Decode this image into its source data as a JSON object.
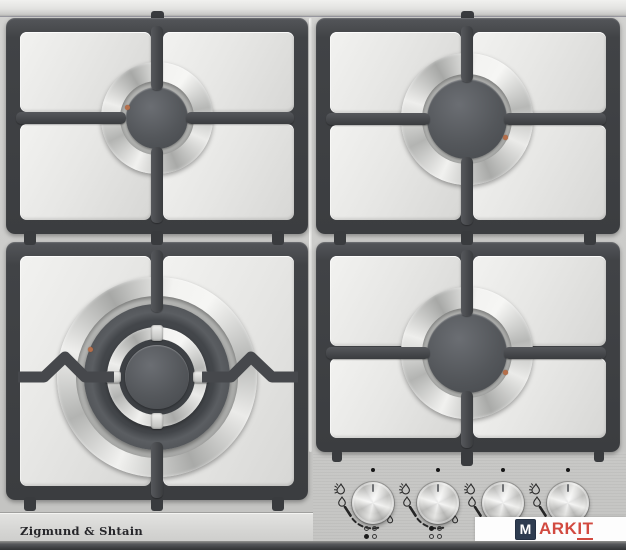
{
  "scene": {
    "type": "product-photo",
    "subject": "Built-in 4-burner gas hob, stainless steel, cast-iron pan supports, 4 control knobs"
  },
  "brand": {
    "label": "Zigmund & Shtain"
  },
  "watermark": {
    "m": "M",
    "ark": "ARK",
    "it": "IT",
    "navy": "#2e3c50",
    "red": "#d24a40",
    "box": "#fdfdfd"
  },
  "palette": {
    "steel_surface": "#cdcdcb",
    "steel_panel": "#e8e8e6",
    "grate": "#3f4144",
    "burner_cap": "#53565a",
    "chrome": "#dcdcda",
    "igniter_dot": "#b56f4b",
    "bottom_edge": "#47494b"
  },
  "burners": [
    {
      "id": "rear-left",
      "size": "medium"
    },
    {
      "id": "rear-right",
      "size": "large"
    },
    {
      "id": "front-left",
      "size": "wok-double-crown"
    },
    {
      "id": "front-right",
      "size": "large"
    }
  ],
  "control_panel": {
    "knob_count": 4,
    "knobs": [
      {
        "id": "knob-1",
        "burner_indicator": "front-left"
      },
      {
        "id": "knob-2",
        "burner_indicator": "rear-left"
      },
      {
        "id": "knob-3",
        "burner_indicator": "not-visible"
      },
      {
        "id": "knob-4",
        "burner_indicator": "not-visible"
      }
    ],
    "symbols": [
      "flame-large",
      "flame-small",
      "dashed-power-arc",
      "position-dot",
      "burner-position-grid"
    ]
  }
}
